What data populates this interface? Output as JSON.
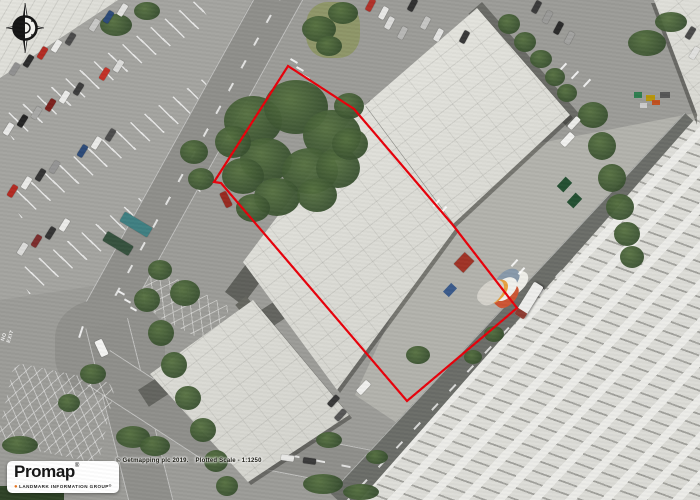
{
  "map": {
    "canvas_label": "Aerial photograph plot",
    "boundary": {
      "points": "288,66 354,109 452,224 517,308 407,401 221,183 214,182",
      "color": "#e8000a",
      "description": "plotted site boundary"
    },
    "compass": {
      "label": "north-compass"
    },
    "road_text": {
      "no_exit": "NO EXIT"
    },
    "logo": {
      "brand": "Promap",
      "brand_mark": "®",
      "tagline": "LANDMARK INFORMATION GROUP",
      "tagline_mark": "®",
      "dot_color": "#e87722"
    },
    "attribution": {
      "copyright": "© Getmapping plc 2019.",
      "scale": "Plotted Scale -  1:1250"
    }
  }
}
